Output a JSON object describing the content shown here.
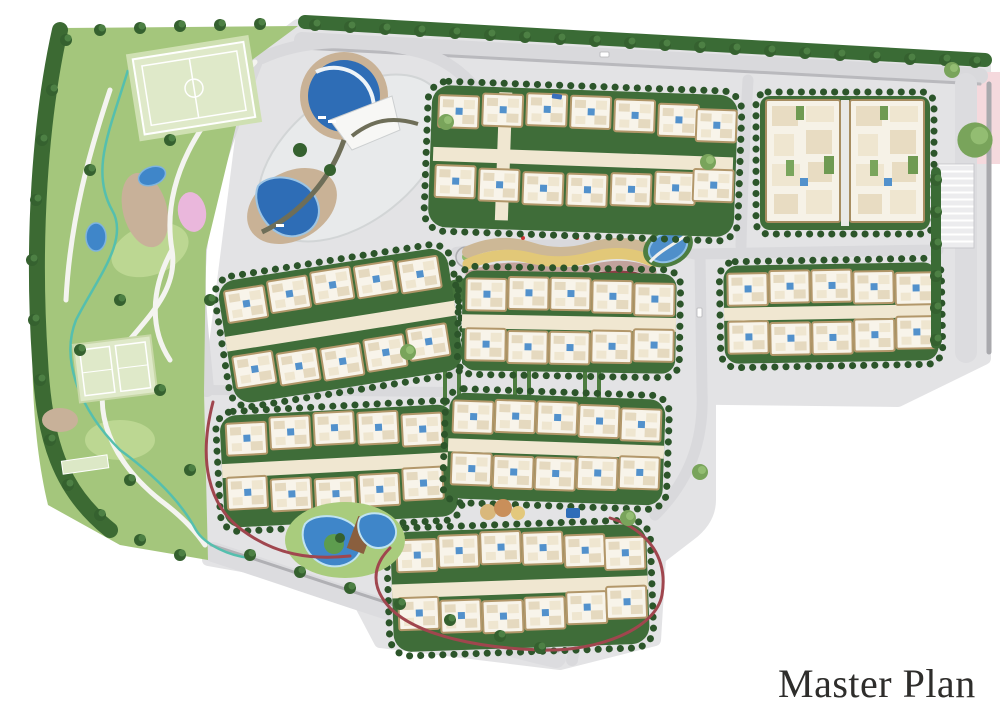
{
  "title": {
    "label": "Master Plan"
  },
  "map": {
    "type": "residential-development-site-plan",
    "features": [
      "perimeter-park",
      "football-field",
      "tennis-courts",
      "bocce-court",
      "clubhouse-with-lagoon-pools",
      "residential-building-clusters",
      "central-dune-play-band",
      "lagoon-pool-garden",
      "kids-play-circles",
      "jogging-track",
      "internal-roads",
      "roundabouts",
      "parking-bays",
      "stream",
      "tree-buffer",
      "pink-street-strip"
    ],
    "palette": {
      "site_hardscape": "#e3e3e5",
      "road": "#d9d9dc",
      "road_median": "#a9a9ad",
      "park_green": "#a4c67c",
      "lawn_light": "#bcd792",
      "tree_dark": "#35612f",
      "field_green": "#dfe9c9",
      "water_blue": "#2e6db6",
      "pond_blue": "#4f8fca",
      "building_fill": "#f8f4ea",
      "building_stroke": "#b2976a",
      "spine_cream": "#f0e7d1",
      "cluster_courtyard": "#3f6d39",
      "track_red": "#a0464e",
      "band_sand": "#cdb896",
      "band_yellow": "#e2c878",
      "band_mauve": "#c2a29c",
      "band_red": "#8e3e46",
      "flower_pink": "#eab7dc",
      "street_pink": "#f5d9dd",
      "stream_teal": "#55bfae",
      "title_text": "#2e2d2b"
    }
  }
}
